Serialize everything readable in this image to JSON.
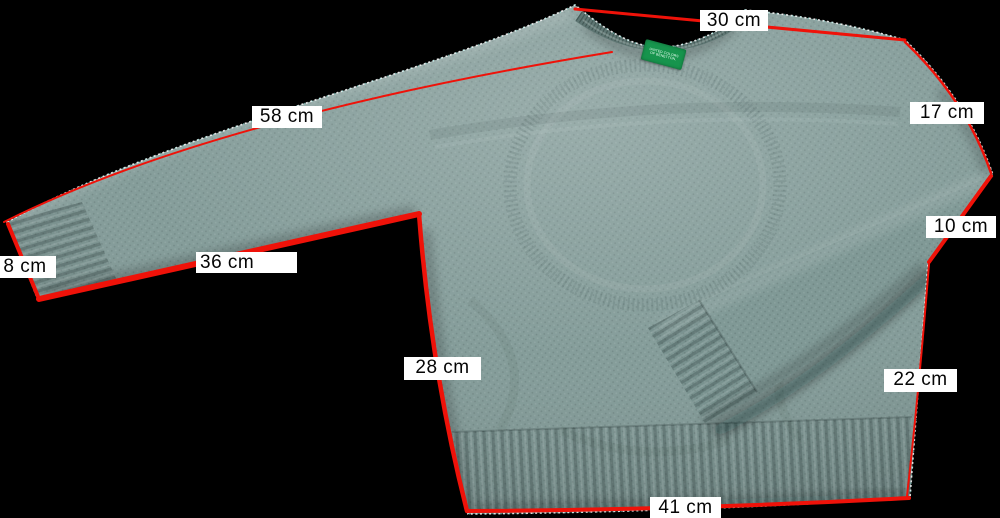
{
  "colors": {
    "background": "#000000",
    "sweater_base": "#809996",
    "sweater_shadow": "#5e7673",
    "sweater_highlight": "#a3b8b4",
    "measurement_line": "#ef1209",
    "label_bg": "#ffffff",
    "label_text": "#050505",
    "tag_green": "#17944d",
    "tag_text": "#eafff2",
    "cutout_outline": "#ffffff"
  },
  "measurements": {
    "shoulder": {
      "label": "30 cm"
    },
    "sleeve_outer": {
      "label": "58 cm"
    },
    "sleeve_upper": {
      "label": "17 cm"
    },
    "cuff_right": {
      "label": "10 cm"
    },
    "cuff_left": {
      "label": "8 cm"
    },
    "sleeve_under": {
      "label": "36 cm"
    },
    "body_side": {
      "label": "28 cm"
    },
    "body_right": {
      "label": "22 cm"
    },
    "hem": {
      "label": "41 cm"
    }
  },
  "brand_tag": {
    "line1": "UNITED COLORS",
    "line2": "OF BENETTON."
  }
}
